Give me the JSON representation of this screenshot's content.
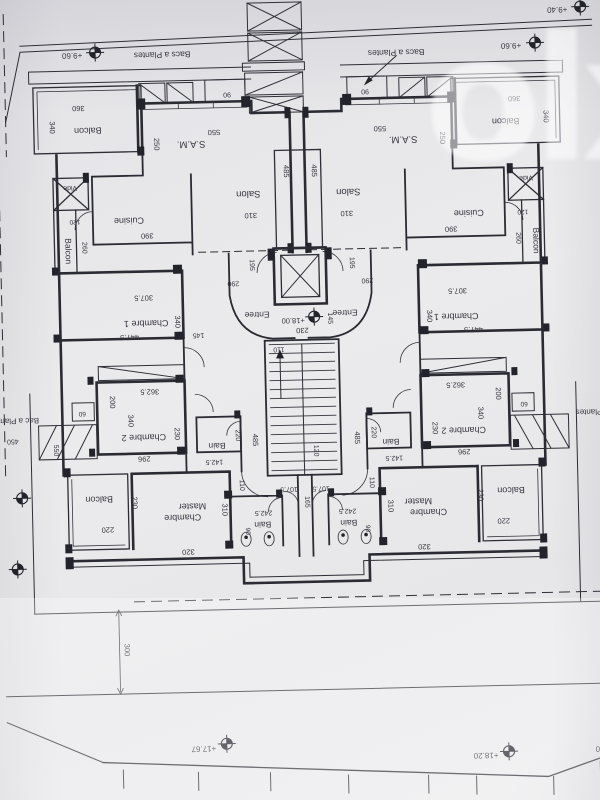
{
  "watermark": {
    "text": "olx"
  },
  "icons": {
    "elevation_marker": "crosshair-circle-target",
    "stairs_arrow": "arrow-up",
    "planter_arrow": "leader-arrow",
    "elevator": "x-crossed-square",
    "vide_shaft": "x-crossed-square"
  },
  "floorplan": {
    "orientation_note": "sheet photographed rotated 180deg; all text upside down",
    "apartments": [
      "left",
      "right"
    ],
    "room_names": [
      "Balcon",
      "S.A.M.",
      "Salon",
      "Cuisine",
      "Vide",
      "Chambre 1",
      "Chambre 2",
      "Bain",
      "Chambre Master",
      "Entree",
      "Bacs a Plantes",
      "Bac a Plantes"
    ],
    "elevations": [
      "+9.40",
      "+9.60",
      "+17.67",
      "+18.00",
      "+18.20"
    ],
    "labels": [
      {
        "t": "Balcon",
        "x": 94,
        "y": 123,
        "r": 180,
        "s": 9,
        "c": "room"
      },
      {
        "t": "S.A.M.",
        "x": 197,
        "y": 139,
        "r": 180,
        "s": 9.5,
        "c": "room"
      },
      {
        "t": "Salon",
        "x": 253,
        "y": 190,
        "r": 180,
        "s": 9.5,
        "c": "room"
      },
      {
        "t": "Cuisine",
        "x": 133,
        "y": 214,
        "r": 180,
        "s": 9,
        "c": "room"
      },
      {
        "t": "Vide",
        "x": 75,
        "y": 181,
        "r": 180,
        "s": 7,
        "c": "room"
      },
      {
        "t": "Balcon",
        "x": 69,
        "y": 246,
        "r": 90,
        "s": 8.5,
        "c": "room"
      },
      {
        "t": "Chambre 1",
        "x": 148,
        "y": 317,
        "r": 180,
        "s": 9,
        "c": "room"
      },
      {
        "t": "Chambre 2",
        "x": 143,
        "y": 431,
        "r": 180,
        "s": 9,
        "c": "room"
      },
      {
        "t": "Bain",
        "x": 216,
        "y": 441,
        "r": 180,
        "s": 8.5,
        "c": "room"
      },
      {
        "t": "Balcon",
        "x": 97,
        "y": 492,
        "r": 180,
        "s": 9,
        "c": "room"
      },
      {
        "t": "Master",
        "x": 190,
        "y": 501,
        "r": 180,
        "s": 9,
        "c": "room"
      },
      {
        "t": "Chambre",
        "x": 180,
        "y": 512,
        "r": 180,
        "s": 9,
        "c": "room"
      },
      {
        "t": "Bain",
        "x": 260,
        "y": 521,
        "r": 180,
        "s": 8.5,
        "c": "room"
      },
      {
        "t": "Entree",
        "x": 259,
        "y": 311,
        "r": 180,
        "s": 8.5,
        "c": "room"
      },
      {
        "t": "Balcon",
        "x": 512,
        "y": 123,
        "r": 180,
        "s": 9,
        "c": "room"
      },
      {
        "t": "S.A.M.",
        "x": 409,
        "y": 139,
        "r": 180,
        "s": 9.5,
        "c": "room"
      },
      {
        "t": "Salon",
        "x": 353,
        "y": 190,
        "r": 180,
        "s": 9.5,
        "c": "room"
      },
      {
        "t": "Cuisine",
        "x": 473,
        "y": 214,
        "r": 180,
        "s": 9,
        "c": "room"
      },
      {
        "t": "Vide",
        "x": 531,
        "y": 181,
        "r": 180,
        "s": 7,
        "c": "room"
      },
      {
        "t": "Balcon",
        "x": 537,
        "y": 246,
        "r": 90,
        "s": 8.5,
        "c": "room"
      },
      {
        "t": "Chambre 1",
        "x": 458,
        "y": 317,
        "r": 180,
        "s": 9,
        "c": "room"
      },
      {
        "t": "Chambre 2",
        "x": 463,
        "y": 431,
        "r": 180,
        "s": 9,
        "c": "room"
      },
      {
        "t": "Bain",
        "x": 390,
        "y": 441,
        "r": 180,
        "s": 8.5,
        "c": "room"
      },
      {
        "t": "Balcon",
        "x": 509,
        "y": 492,
        "r": 180,
        "s": 9,
        "c": "room"
      },
      {
        "t": "Master",
        "x": 416,
        "y": 501,
        "r": 180,
        "s": 9,
        "c": "room"
      },
      {
        "t": "Chambre",
        "x": 426,
        "y": 512,
        "r": 180,
        "s": 9,
        "c": "room"
      },
      {
        "t": "Bain",
        "x": 346,
        "y": 521,
        "r": 180,
        "s": 8.5,
        "c": "room"
      },
      {
        "t": "Entree",
        "x": 347,
        "y": 311,
        "r": 180,
        "s": 8.5,
        "c": "room"
      },
      {
        "t": "Bacs a Plantes",
        "x": 170,
        "y": 49,
        "r": 180,
        "s": 8.5,
        "c": "site"
      },
      {
        "t": "Bacs a Plantes",
        "x": 404,
        "y": 52,
        "r": 180,
        "s": 8.5,
        "c": "site"
      },
      {
        "t": "Bac a Plantes",
        "x": 14,
        "y": 412,
        "r": 180,
        "s": 8,
        "c": "site"
      },
      {
        "t": "Bac a Plantes",
        "x": 600,
        "y": 416,
        "r": 180,
        "s": 8,
        "c": "site"
      },
      {
        "t": "+9.60",
        "x": 80,
        "y": 48,
        "r": 180,
        "s": 8,
        "c": "elevation"
      },
      {
        "t": "+9.60",
        "x": 519,
        "y": 48,
        "r": 180,
        "s": 8,
        "c": "elevation"
      },
      {
        "t": "+9.40",
        "x": 566,
        "y": 13,
        "r": 180,
        "s": 8,
        "c": "elevation"
      },
      {
        "t": "+18.00",
        "x": 295,
        "y": 318,
        "r": 180,
        "s": 7.5,
        "c": "elevation"
      },
      {
        "t": "+17.67",
        "x": 196,
        "y": 744,
        "r": 180,
        "s": 8,
        "c": "elevation"
      },
      {
        "t": "+18.20",
        "x": 478,
        "y": 757,
        "r": 180,
        "s": 8,
        "c": "elevation"
      },
      {
        "t": "+18.20",
        "x": 600,
        "y": 753,
        "r": 180,
        "s": 8,
        "c": "elevation"
      },
      {
        "t": "360",
        "x": 85,
        "y": 101,
        "r": 180,
        "s": 7.5,
        "c": "dim"
      },
      {
        "t": "340",
        "x": 56,
        "y": 122,
        "r": 90,
        "s": 7.5,
        "c": "dim"
      },
      {
        "t": "550",
        "x": 220,
        "y": 128,
        "r": 180,
        "s": 7.5,
        "c": "dim"
      },
      {
        "t": "250",
        "x": 160,
        "y": 141,
        "r": 90,
        "s": 7.5,
        "c": "dim"
      },
      {
        "t": "310",
        "x": 255,
        "y": 212,
        "r": 180,
        "s": 7.5,
        "c": "dim"
      },
      {
        "t": "485",
        "x": 289,
        "y": 171,
        "r": 90,
        "s": 7.5,
        "c": "dim"
      },
      {
        "t": "390",
        "x": 151,
        "y": 230,
        "r": 180,
        "s": 7.5,
        "c": "dim"
      },
      {
        "t": "260",
        "x": 86,
        "y": 243,
        "r": 90,
        "s": 7,
        "c": "dim"
      },
      {
        "t": "120",
        "x": 79,
        "y": 215,
        "r": 180,
        "s": 6.5,
        "c": "dim"
      },
      {
        "t": "307.5",
        "x": 146,
        "y": 292,
        "r": 180,
        "s": 7.5,
        "c": "dim"
      },
      {
        "t": "447.5",
        "x": 131,
        "y": 331,
        "r": 180,
        "s": 7.5,
        "c": "dim"
      },
      {
        "t": "340",
        "x": 177,
        "y": 319,
        "r": 90,
        "s": 7.5,
        "c": "dim"
      },
      {
        "t": "145",
        "x": 200,
        "y": 331,
        "r": 180,
        "s": 7,
        "c": "dim"
      },
      {
        "t": "290",
        "x": 236,
        "y": 280,
        "r": 180,
        "s": 7,
        "c": "dim"
      },
      {
        "t": "195",
        "x": 253,
        "y": 264,
        "r": 90,
        "s": 7,
        "c": "dim"
      },
      {
        "t": "362.5",
        "x": 150,
        "y": 386,
        "r": 180,
        "s": 7.5,
        "c": "dim"
      },
      {
        "t": "200",
        "x": 110,
        "y": 398,
        "r": 90,
        "s": 7.5,
        "c": "dim"
      },
      {
        "t": "60",
        "x": 82,
        "y": 407,
        "r": 180,
        "s": 6.5,
        "c": "dim"
      },
      {
        "t": "340",
        "x": 128,
        "y": 417,
        "r": 90,
        "s": 7.5,
        "c": "dim"
      },
      {
        "t": "230",
        "x": 174,
        "y": 431,
        "r": 90,
        "s": 7.5,
        "c": "dim"
      },
      {
        "t": "296",
        "x": 143,
        "y": 453,
        "r": 180,
        "s": 7.5,
        "c": "dim"
      },
      {
        "t": "142.5",
        "x": 213,
        "y": 458,
        "r": 180,
        "s": 7,
        "c": "dim"
      },
      {
        "t": "220",
        "x": 235,
        "y": 434,
        "r": 90,
        "s": 7,
        "c": "dim"
      },
      {
        "t": "230",
        "x": 130,
        "y": 499,
        "r": 90,
        "s": 7.5,
        "c": "dim"
      },
      {
        "t": "220",
        "x": 105,
        "y": 523,
        "r": 180,
        "s": 7.5,
        "c": "dim"
      },
      {
        "t": "310",
        "x": 220,
        "y": 508,
        "r": 90,
        "s": 7.5,
        "c": "dim"
      },
      {
        "t": "320",
        "x": 185,
        "y": 547,
        "r": 180,
        "s": 7.5,
        "c": "dim"
      },
      {
        "t": "242.5",
        "x": 261,
        "y": 510,
        "r": 180,
        "s": 7,
        "c": "dim"
      },
      {
        "t": "90",
        "x": 243,
        "y": 530,
        "r": 90,
        "s": 6.5,
        "c": "dim"
      },
      {
        "t": "107.5",
        "x": 287,
        "y": 487,
        "r": 180,
        "s": 7,
        "c": "dim"
      },
      {
        "t": "110",
        "x": 238,
        "y": 484,
        "r": 90,
        "s": 7,
        "c": "dim"
      },
      {
        "t": "485",
        "x": 252,
        "y": 439,
        "r": 90,
        "s": 7.5,
        "c": "dim"
      },
      {
        "t": "90",
        "x": 234,
        "y": 91,
        "r": 180,
        "s": 7,
        "c": "dim"
      },
      {
        "t": "230",
        "x": 304,
        "y": 328,
        "r": 180,
        "s": 7.5,
        "c": "dim"
      },
      {
        "t": "145",
        "x": 330,
        "y": 319,
        "r": 90,
        "s": 7,
        "c": "dim"
      },
      {
        "t": "110",
        "x": 280,
        "y": 347,
        "r": 180,
        "s": 7,
        "c": "dim"
      },
      {
        "t": "120",
        "x": 313,
        "y": 451,
        "r": 90,
        "s": 7,
        "c": "dim"
      },
      {
        "t": "165",
        "x": 303,
        "y": 502,
        "r": 90,
        "s": 7,
        "c": "dim"
      },
      {
        "t": "360",
        "x": 521,
        "y": 101,
        "r": 180,
        "s": 7.5,
        "c": "dim"
      },
      {
        "t": "340",
        "x": 550,
        "y": 122,
        "r": 90,
        "s": 7.5,
        "c": "dim"
      },
      {
        "t": "550",
        "x": 386,
        "y": 128,
        "r": 180,
        "s": 7.5,
        "c": "dim"
      },
      {
        "t": "250",
        "x": 446,
        "y": 141,
        "r": 90,
        "s": 7.5,
        "c": "dim"
      },
      {
        "t": "310",
        "x": 351,
        "y": 212,
        "r": 180,
        "s": 7.5,
        "c": "dim"
      },
      {
        "t": "485",
        "x": 317,
        "y": 171,
        "r": 90,
        "s": 7.5,
        "c": "dim"
      },
      {
        "t": "390",
        "x": 455,
        "y": 230,
        "r": 180,
        "s": 7.5,
        "c": "dim"
      },
      {
        "t": "260",
        "x": 520,
        "y": 243,
        "r": 90,
        "s": 7,
        "c": "dim"
      },
      {
        "t": "120",
        "x": 527,
        "y": 215,
        "r": 180,
        "s": 6.5,
        "c": "dim"
      },
      {
        "t": "307.5",
        "x": 460,
        "y": 292,
        "r": 180,
        "s": 7.5,
        "c": "dim"
      },
      {
        "t": "447.5",
        "x": 475,
        "y": 331,
        "r": 180,
        "s": 7.5,
        "c": "dim"
      },
      {
        "t": "340",
        "x": 429,
        "y": 319,
        "r": 90,
        "s": 7.5,
        "c": "dim"
      },
      {
        "t": "290",
        "x": 370,
        "y": 280,
        "r": 180,
        "s": 7,
        "c": "dim"
      },
      {
        "t": "195",
        "x": 353,
        "y": 264,
        "r": 90,
        "s": 7,
        "c": "dim"
      },
      {
        "t": "362.5",
        "x": 456,
        "y": 386,
        "r": 180,
        "s": 7.5,
        "c": "dim"
      },
      {
        "t": "200",
        "x": 496,
        "y": 398,
        "r": 90,
        "s": 7.5,
        "c": "dim"
      },
      {
        "t": "60",
        "x": 524,
        "y": 407,
        "r": 180,
        "s": 6.5,
        "c": "dim"
      },
      {
        "t": "340",
        "x": 478,
        "y": 417,
        "r": 90,
        "s": 7.5,
        "c": "dim"
      },
      {
        "t": "230",
        "x": 432,
        "y": 431,
        "r": 90,
        "s": 7.5,
        "c": "dim"
      },
      {
        "t": "296",
        "x": 463,
        "y": 453,
        "r": 180,
        "s": 7.5,
        "c": "dim"
      },
      {
        "t": "142.5",
        "x": 393,
        "y": 458,
        "r": 180,
        "s": 7,
        "c": "dim"
      },
      {
        "t": "220",
        "x": 371,
        "y": 434,
        "r": 90,
        "s": 7,
        "c": "dim"
      },
      {
        "t": "230",
        "x": 476,
        "y": 499,
        "r": 90,
        "s": 7.5,
        "c": "dim"
      },
      {
        "t": "220",
        "x": 501,
        "y": 523,
        "r": 180,
        "s": 7.5,
        "c": "dim"
      },
      {
        "t": "310",
        "x": 386,
        "y": 508,
        "r": 90,
        "s": 7.5,
        "c": "dim"
      },
      {
        "t": "320",
        "x": 421,
        "y": 547,
        "r": 180,
        "s": 7.5,
        "c": "dim"
      },
      {
        "t": "242.5",
        "x": 345,
        "y": 510,
        "r": 180,
        "s": 7,
        "c": "dim"
      },
      {
        "t": "90",
        "x": 363,
        "y": 530,
        "r": 90,
        "s": 6.5,
        "c": "dim"
      },
      {
        "t": "107.5",
        "x": 319,
        "y": 487,
        "r": 180,
        "s": 7,
        "c": "dim"
      },
      {
        "t": "110",
        "x": 368,
        "y": 484,
        "r": 90,
        "s": 7,
        "c": "dim"
      },
      {
        "t": "485",
        "x": 354,
        "y": 439,
        "r": 90,
        "s": 7.5,
        "c": "dim"
      },
      {
        "t": "90",
        "x": 372,
        "y": 91,
        "r": 180,
        "s": 7,
        "c": "dim"
      },
      {
        "t": "300",
        "x": 119,
        "y": 646,
        "r": 90,
        "s": 7.5,
        "c": "dim"
      },
      {
        "t": "450",
        "x": 12,
        "y": 433,
        "r": 180,
        "s": 7,
        "c": "dim"
      },
      {
        "t": "550",
        "x": 53,
        "y": 445,
        "r": 90,
        "s": 7,
        "c": "dim"
      }
    ]
  }
}
